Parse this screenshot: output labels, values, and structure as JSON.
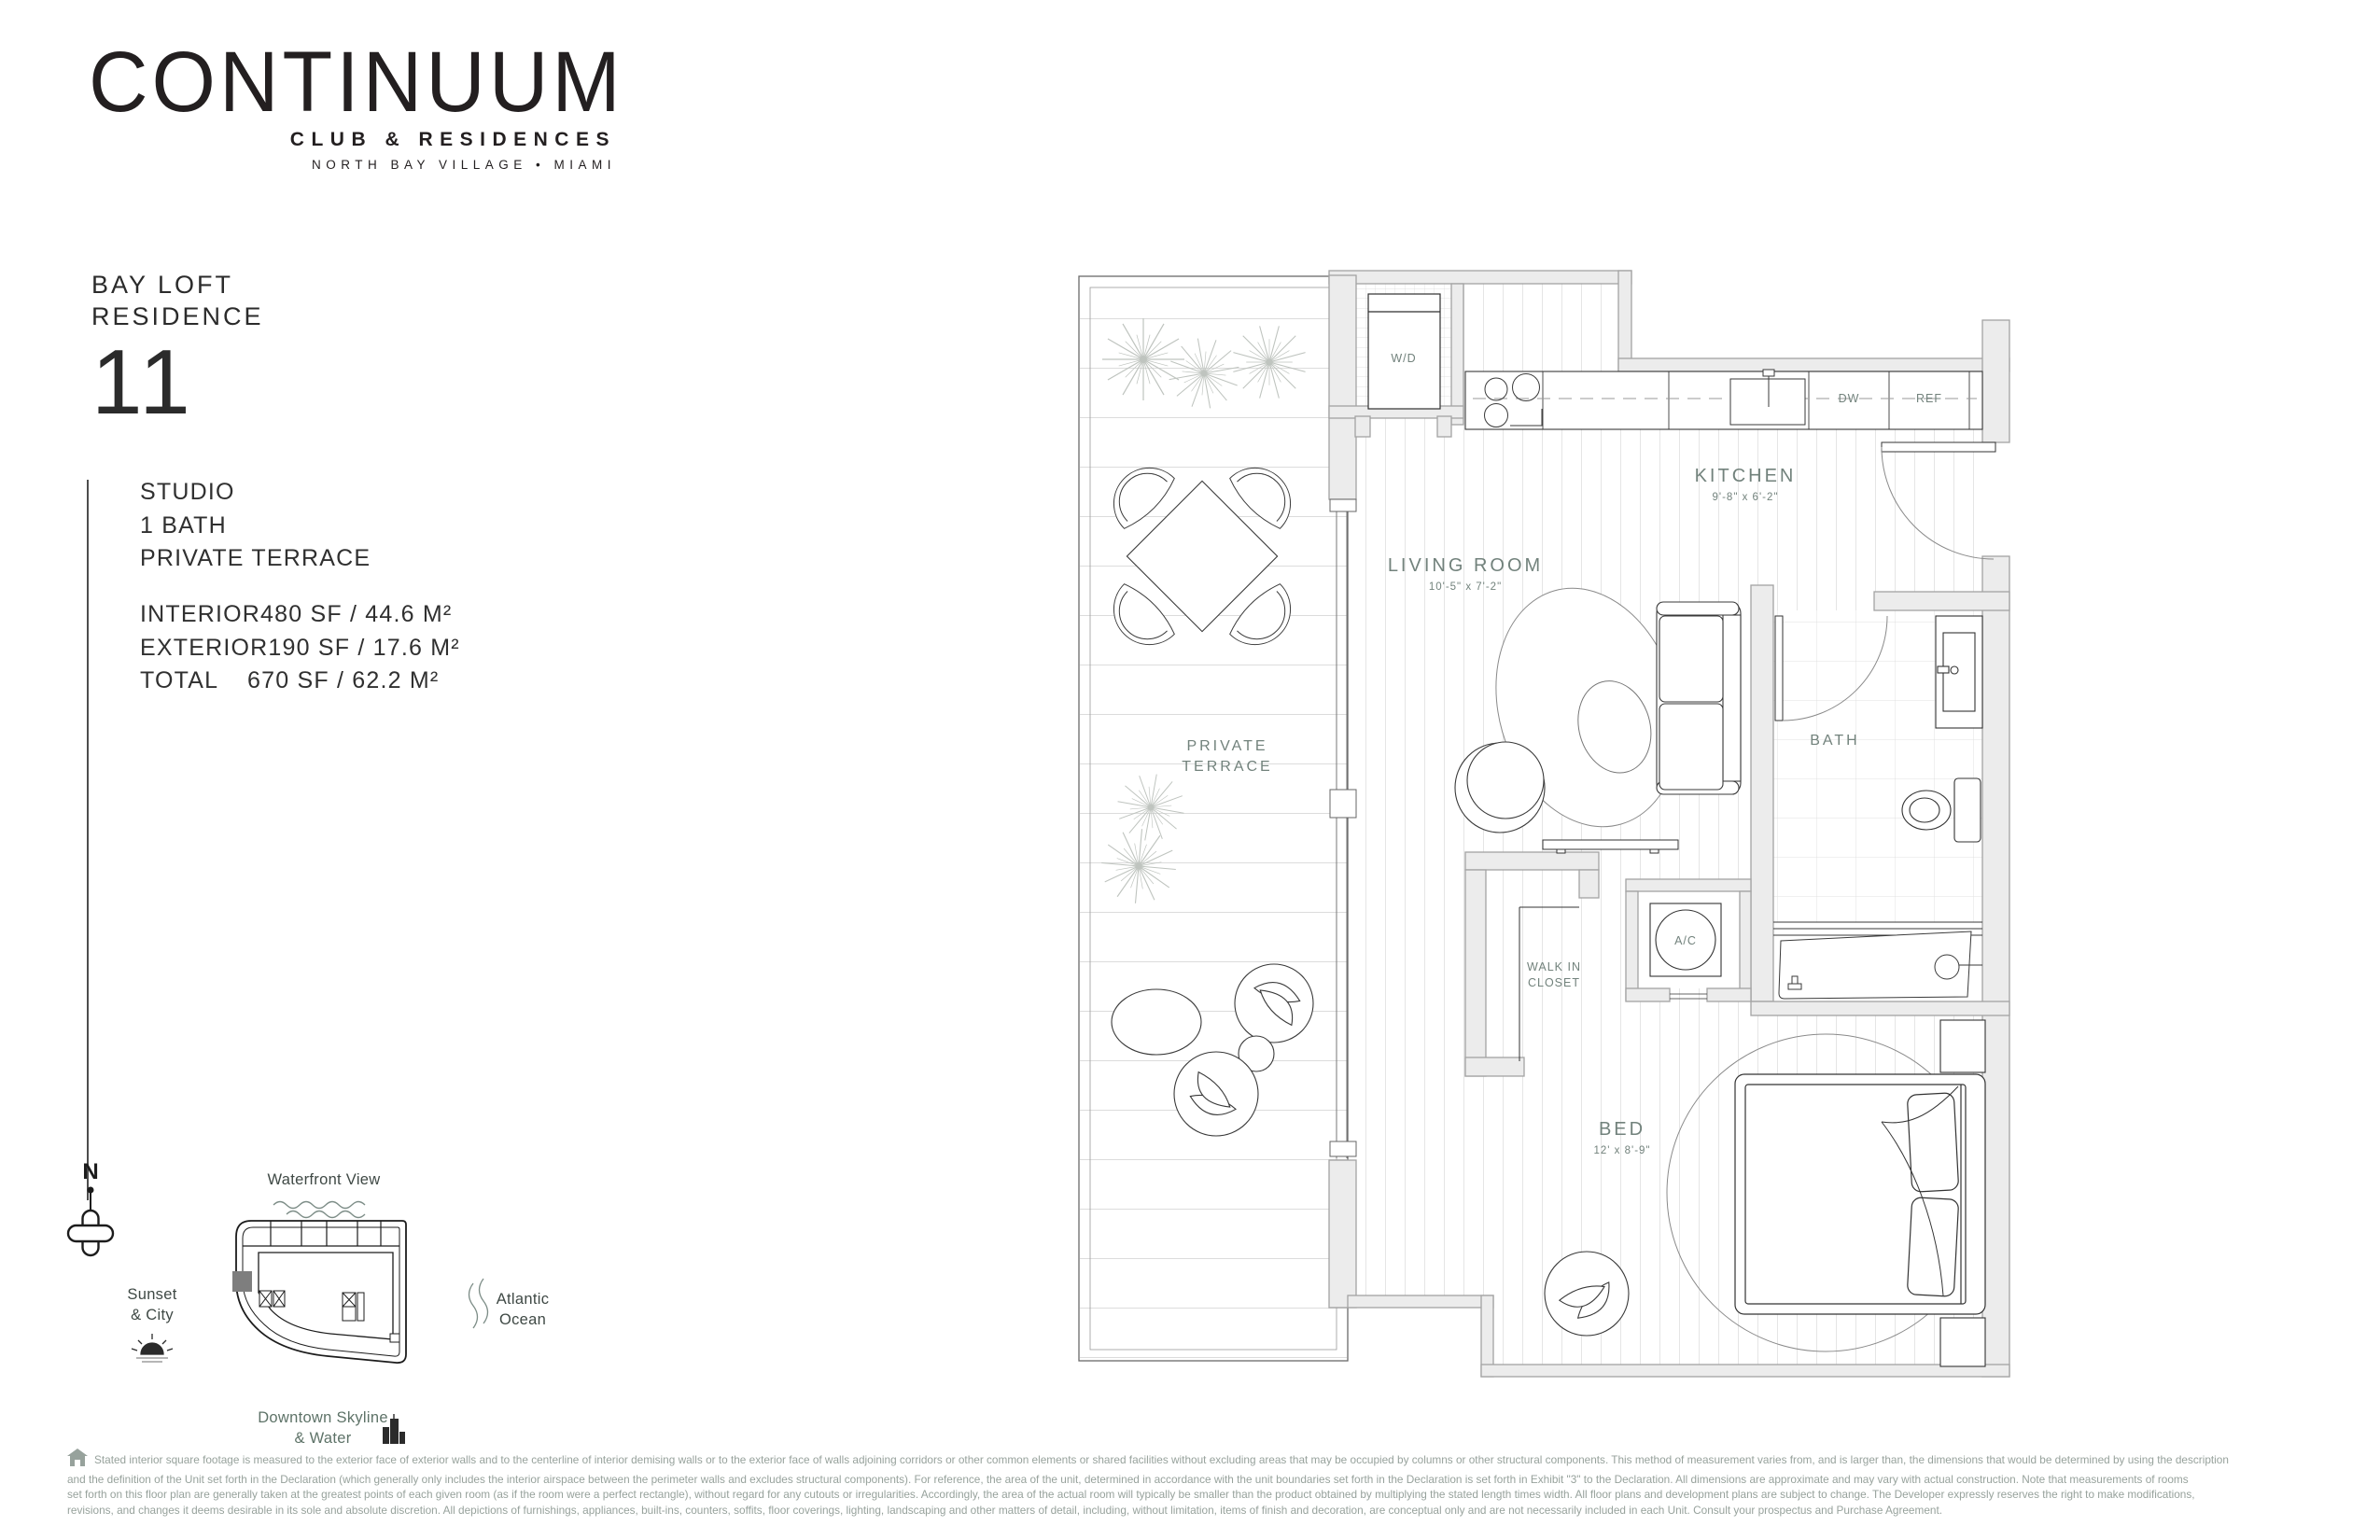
{
  "brand": {
    "name": "CONTINUUM",
    "tagline": "CLUB & RESIDENCES",
    "location": "NORTH BAY VILLAGE • MIAMI"
  },
  "residence": {
    "name_line1": "BAY LOFT",
    "name_line2": "RESIDENCE",
    "number": "11",
    "features": [
      "STUDIO",
      "1 BATH",
      "PRIVATE TERRACE"
    ],
    "areas": [
      {
        "label": "INTERIOR",
        "value": "480 SF / 44.6 M²"
      },
      {
        "label": "EXTERIOR",
        "value": "190 SF / 17.6 M²"
      },
      {
        "label": "TOTAL",
        "value": "670 SF / 62.2 M²"
      }
    ]
  },
  "floorplan": {
    "labels": {
      "wd": "W/D",
      "dw": "DW",
      "ref": "REF",
      "kitchen": "KITCHEN",
      "kitchen_dims": "9'-8\" x 6'-2\"",
      "living": "LIVING ROOM",
      "living_dims": "10'-5\" x 7'-2\"",
      "terrace_1": "PRIVATE",
      "terrace_2": "TERRACE",
      "bath": "BATH",
      "wic_1": "WALK IN",
      "wic_2": "CLOSET",
      "ac": "A/C",
      "bed": "BED",
      "bed_dims": "12' x 8'-9\""
    }
  },
  "keyplan": {
    "north": "N",
    "waterfront": "Waterfront View",
    "sunset_1": "Sunset",
    "sunset_2": "& City",
    "atlantic_1": "Atlantic",
    "atlantic_2": "Ocean",
    "downtown_1": "Downtown Skyline",
    "downtown_2": "& Water"
  },
  "disclaimer": {
    "lines": [
      "Stated interior square footage is measured to the exterior face of exterior walls and to the centerline of interior demising walls or to the exterior face of walls adjoining corridors or other common elements or shared facilities without excluding areas that may be occupied by columns or other structural components. This method of measurement varies from, and is larger than, the dimensions that would be determined by using the description",
      "and the definition of the Unit set forth in the Declaration (which generally only includes the interior airspace between the perimeter walls and excludes structural components). For reference, the area of the unit, determined in accordance with the unit boundaries set forth in the Declaration is set forth in Exhibit \"3\" to the Declaration. All dimensions are approximate and may vary with actual construction. Note that measurements of rooms",
      "set forth on this floor plan are generally taken at the greatest points of each given room (as if the room were a perfect rectangle), without regard for any cutouts or irregularities. Accordingly, the area of the actual room will typically be smaller than the product obtained by multiplying the stated length times width. All floor plans and development plans are subject to change. The Developer expressly reserves the right to make modifications,",
      "revisions, and changes it deems desirable in its sole and absolute discretion. All depictions of furnishings, appliances, built-ins, counters, soffits, floor coverings, lighting, landscaping and other matters of detail, including, without limitation, items of finish and decoration, are conceptual only and are not necessarily included in each Unit. Consult your prospectus and Purchase Agreement."
    ]
  },
  "colors": {
    "label": "#72827C",
    "map_text": "#3F4945",
    "downtown_text": "#5E7368",
    "disclaimer_text": "#97A29C",
    "wall_fill": "#ECECEC",
    "wall_stroke": "#A3A3A3",
    "unit_marker": "#7E7E7E",
    "ink": "#231F20"
  }
}
